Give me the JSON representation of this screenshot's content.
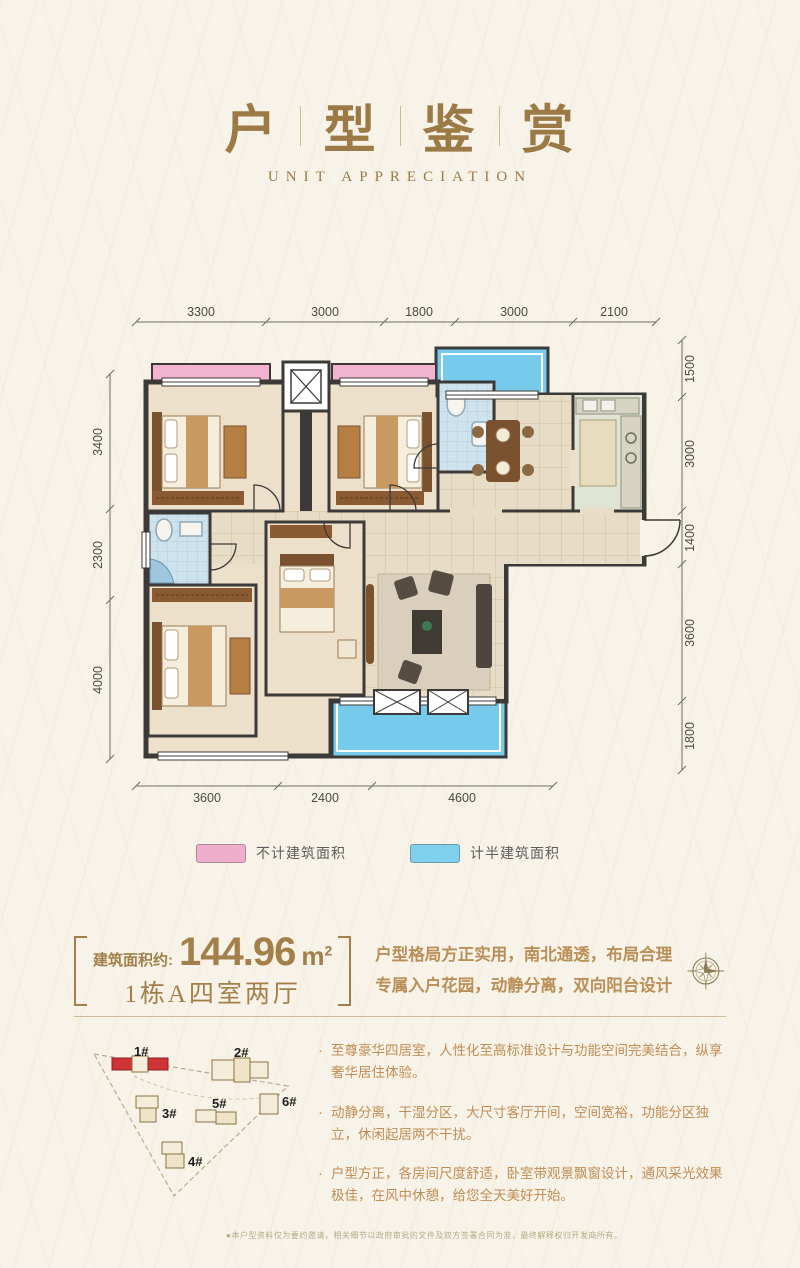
{
  "header": {
    "t0": "户",
    "t1": "型",
    "t2": "鉴",
    "t3": "赏",
    "subtitle": "UNIT APPRECIATION"
  },
  "plan": {
    "dims_top": [
      "3300",
      "3000",
      "1800",
      "3000",
      "2100"
    ],
    "dims_left": [
      "3400",
      "2300",
      "4000"
    ],
    "dims_right": [
      "1500",
      "3000",
      "1400",
      "3600",
      "1800"
    ],
    "dims_bottom": [
      "3600",
      "2400",
      "4600"
    ],
    "colors": {
      "wall": "#3c3a38",
      "room_fill": "#ece0cb",
      "tile_fill": "#e7dcc5",
      "bath_fill": "#cfe3ee",
      "kitchen_fill": "#e0e4d4",
      "bay_pink": "#f2b3d1",
      "balcony_blue": "#76cbec"
    }
  },
  "legend": {
    "item1": "不计建筑面积",
    "item2": "计半建筑面积",
    "pink": "#f0aecd",
    "blue": "#7fd0ef"
  },
  "info": {
    "area_label": "建筑面积约:",
    "area_value": "144.96",
    "area_unit": "m",
    "area_sup": "2",
    "unit_title": "1栋A四室两厅",
    "desc1": "户型格局方正实用，南北通透，布局合理",
    "desc2": "专属入户花园，动静分离，双向阳台设计"
  },
  "siteplan": {
    "labels": [
      "1#",
      "2#",
      "3#",
      "4#",
      "5#",
      "6#"
    ],
    "highlight_color": "#cf3333"
  },
  "bullets": [
    "至尊豪华四居室，人性化至高标准设计与功能空间完美结合，纵享奢华居住体验。",
    "动静分离，干湿分区，大尺寸客厅开间，空间宽裕，功能分区独立，休闲起居两不干扰。",
    "户型方正，各房间尺度舒适，卧室带观景飘窗设计，通风采光效果极佳，在风中休憩，给您全天美好开始。"
  ],
  "footnote": "●本户型资料仅为要约邀请，相关细节以政府审批的文件及双方签署合同为准，最终解释权归开发商所有。"
}
